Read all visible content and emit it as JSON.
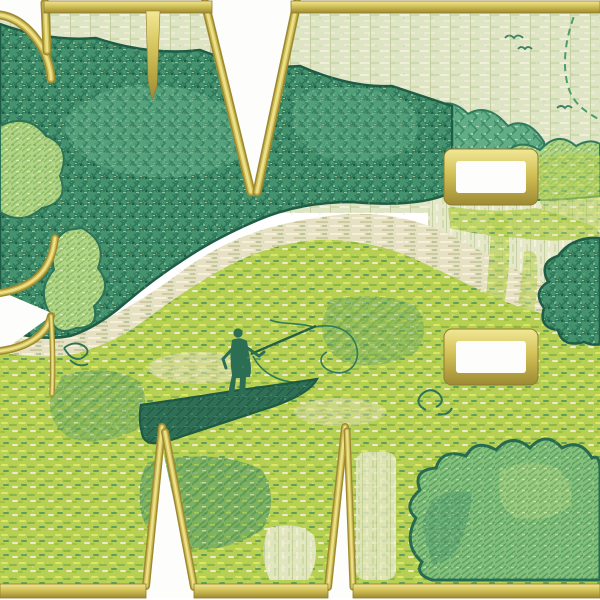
{
  "meta": {
    "description": "Machine-embroidery stitched preview: green landscape scene (fisherman standing in a boat on a river, forest, meadow, bushes, birds) filling large letterforms outlined in gold satin stitch on a white ground",
    "canvas": {
      "width": 600,
      "height": 600
    }
  },
  "palette": {
    "white_ground": "#fdfdfb",
    "gold_layers": [
      "#9d8a33",
      "#cdbb55",
      "#ede187"
    ],
    "gold_gradient": [
      "#f2e795",
      "#d2c157",
      "#9d8a33"
    ],
    "outline_dark_green": "#1f5c46",
    "forest_green": "#44926e",
    "forest_light": "#61ad85",
    "bush_light": "#b2d488",
    "bush_mid": "#83c07c",
    "meadow_chartreuse": "#b7cf52",
    "meadow_dark": "#74ad62",
    "sky_sage": "#dde5c4",
    "river_cream": "#e6e1c2",
    "field_pale": "#e6e8ca",
    "boat_teal": "#2e6f55",
    "figure_teal": "#2c6e54",
    "bird_green": "#38805f",
    "arc_green": "#4a9e6a"
  },
  "scene": {
    "elements": [
      {
        "name": "sky",
        "tag": "rect",
        "attrs": {
          "x": 0,
          "y": 8,
          "width": 600,
          "height": 205,
          "fill": "url(#pSky)"
        }
      },
      {
        "name": "pale-field-right",
        "tag": "path",
        "attrs": {
          "d": "M428,186 L600,186 L600,352 L428,352 Z",
          "fill": "url(#pField)"
        }
      },
      {
        "name": "distant-hills",
        "tag": "path",
        "attrs": {
          "d": "M345,188 L345,150 Q362,104 392,118 Q404,96 428,112 Q448,94 468,114 Q488,102 508,126 Q528,116 544,142 L548,188 Q446,200 345,188 Z",
          "fill": "url(#pForestLight)",
          "stroke": "#2f7a5c",
          "stroke-width": 2
        }
      },
      {
        "name": "bush-row-right",
        "tag": "path",
        "attrs": {
          "d": "M468,190 Q478,150 502,158 Q516,136 540,150 Q558,130 576,146 Q590,138 600,144 L600,196 Q534,204 468,196 Z",
          "fill": "url(#pBushLight)",
          "stroke": "#2f7a5c",
          "stroke-width": 2
        }
      },
      {
        "name": "meadow",
        "tag": "path",
        "attrs": {
          "d": "M0,330 Q40,346 80,346 Q130,338 172,296 Q214,254 262,236 Q305,222 345,220 Q395,218 440,240 Q480,262 520,284 Q560,300 600,304 L600,590 L0,590 Z",
          "fill": "url(#pMeadow)"
        }
      },
      {
        "name": "meadow-dark-patch-1",
        "tag": "path",
        "attrs": {
          "d": "M148,462 Q220,448 262,470 Q280,500 262,530 Q220,556 178,548 Q142,538 140,504 Q138,476 148,462 Z",
          "fill": "url(#pMeadowDark)",
          "opacity": 0.85
        }
      },
      {
        "name": "meadow-dark-patch-2",
        "tag": "path",
        "attrs": {
          "d": "M62,376 Q110,362 140,382 Q152,408 136,430 Q100,448 70,438 Q48,424 50,400 Z",
          "fill": "url(#pMeadowDark)",
          "opacity": 0.6
        }
      },
      {
        "name": "meadow-dark-patch-3",
        "tag": "path",
        "attrs": {
          "d": "M330,300 Q380,290 416,306 Q432,330 416,352 Q380,372 344,362 Q320,348 322,322 Z",
          "fill": "url(#pMeadowDark)",
          "opacity": 0.5
        }
      },
      {
        "name": "pale-patch-1",
        "tag": "path",
        "attrs": {
          "d": "M268,528 Q300,520 314,536 Q320,560 308,580 L270,580 Q258,556 268,528 Z",
          "fill": "url(#pField)",
          "opacity": 0.9
        }
      },
      {
        "name": "pale-patch-2",
        "tag": "rect",
        "attrs": {
          "x": 356,
          "y": 452,
          "width": 40,
          "height": 128,
          "rx": 10,
          "fill": "url(#pField)",
          "opacity": 0.8
        }
      },
      {
        "name": "water-glint-1",
        "tag": "ellipse",
        "attrs": {
          "cx": 200,
          "cy": 368,
          "rx": 52,
          "ry": 16,
          "fill": "url(#pRiver)",
          "opacity": 0.55
        }
      },
      {
        "name": "water-glint-2",
        "tag": "ellipse",
        "attrs": {
          "cx": 340,
          "cy": 412,
          "rx": 46,
          "ry": 14,
          "fill": "url(#pRiver)",
          "opacity": 0.45
        }
      },
      {
        "name": "river",
        "tag": "path",
        "attrs": {
          "d": "M0,334 Q60,342 108,318 Q150,296 186,268 Q226,240 268,228 Q312,216 352,214 Q400,212 444,232 Q484,252 524,274 Q562,292 600,296 L600,322 Q540,318 492,296 Q448,274 408,256 Q362,238 316,240 Q268,244 224,268 Q182,292 148,318 Q108,348 64,356 Q28,358 0,352 Z",
          "fill": "url(#pRiver)"
        }
      },
      {
        "name": "forest",
        "tag": "path",
        "attrs": {
          "d": "M0,24 Q50,42 96,38 Q150,56 200,50 Q250,70 300,66 Q350,88 392,86 Q428,98 452,106 L452,148 Q466,168 452,192 Q420,208 352,202 Q300,202 258,220 Q216,238 186,258 Q152,280 124,304 Q96,328 70,336 Q36,342 0,328 Z",
          "fill": "url(#pForest)",
          "stroke": "#1f5c46",
          "stroke-width": 2.5,
          "stroke-linejoin": "round"
        }
      },
      {
        "name": "forest-light-cloud-1",
        "tag": "path",
        "attrs": {
          "d": "M66,118 Q116,68 196,92 Q258,112 240,158 Q182,190 112,170 Q58,150 66,118 Z",
          "fill": "url(#pForestLight)",
          "opacity": 0.6
        }
      },
      {
        "name": "forest-light-cloud-2",
        "tag": "path",
        "attrs": {
          "d": "M296,96 Q348,76 404,100 Q428,120 410,150 Q360,170 316,154 Q284,134 296,96 Z",
          "fill": "url(#pForestLight)",
          "opacity": 0.5
        }
      },
      {
        "name": "canopy-left",
        "tag": "path",
        "attrs": {
          "d": "M0,126 Q28,112 46,136 Q72,146 60,176 Q70,202 42,208 Q22,226 0,212 Z",
          "fill": "url(#pBushLight)",
          "stroke": "#2c7256",
          "stroke-width": 2
        }
      },
      {
        "name": "leaf-clump-left",
        "tag": "path",
        "attrs": {
          "d": "M82,228 Q108,242 98,268 Q114,288 94,306 Q100,328 76,328 Q54,338 50,314 Q36,290 54,270 Q48,240 68,230 Z",
          "fill": "url(#pBushLight)",
          "stroke": "#2c7256",
          "stroke-width": 2
        }
      },
      {
        "name": "leaf-sprig",
        "tag": "path",
        "attrs": {
          "d": "M64,348 q10,-8 20,-2 q8,6 -2,12 q-10,4 -18,-10 M70,360 q8,8 18,4",
          "stroke": "#2c7256",
          "stroke-width": 1.8,
          "fill": "none"
        }
      },
      {
        "name": "meadow-under-rect1",
        "tag": "path",
        "attrs": {
          "d": "M448,206 Q492,214 536,208 Q560,214 588,224 Q600,228 600,236 Q560,244 520,238 Q480,236 450,228 Z",
          "fill": "url(#pMeadow)",
          "opacity": 0.8
        }
      },
      {
        "name": "meadow-right-of-rect1",
        "tag": "path",
        "attrs": {
          "d": "M540,158 Q572,150 600,156 L600,230 Q570,226 544,214 Q534,186 540,158 Z",
          "fill": "url(#pMeadow)",
          "opacity": 0.55
        }
      },
      {
        "name": "field-grass-tuft-1",
        "tag": "path",
        "attrs": {
          "d": "M492,214 q14,-6 16,10 q4,40 -4,80 q-2,24 -12,22 q-8,-4 -6,-30 q4,-44 6,-82 Z",
          "fill": "url(#pMeadow)",
          "opacity": 0.7
        }
      },
      {
        "name": "field-grass-tuft-2",
        "tag": "path",
        "attrs": {
          "d": "M524,252 q12,-4 13,8 q2,30 -4,60 q-3,16 -11,13 q-7,-4 -4,-26 q4,-30 6,-55 Z",
          "fill": "url(#pMeadow)",
          "opacity": 0.6
        }
      },
      {
        "name": "dark-bush-right-edge",
        "tag": "path",
        "attrs": {
          "d": "M600,238 Q572,236 558,256 Q538,262 548,282 Q532,292 544,308 Q538,328 558,330 Q562,348 584,342 Q594,346 600,344 Z",
          "fill": "url(#pForest)",
          "stroke": "#1f5c46",
          "stroke-width": 2.5
        }
      },
      {
        "name": "bush-bottom-right",
        "tag": "path",
        "attrs": {
          "d": "M422,562 Q402,544 416,518 Q402,506 420,490 Q412,470 436,468 Q442,448 466,456 Q476,438 496,450 Q512,432 530,448 Q546,430 562,448 Q580,438 592,458 Q600,454 600,470 L600,580 L432,580 Q414,574 422,562 Z",
          "fill": "url(#pBushMid)",
          "stroke": "#276a50",
          "stroke-width": 3
        }
      },
      {
        "name": "bush-bottom-right-shade",
        "tag": "path",
        "attrs": {
          "d": "M428,548 Q416,522 432,502 Q446,488 472,492 Q470,520 458,548 Q446,566 432,564 Z",
          "fill": "url(#pForest)",
          "opacity": 0.35
        }
      },
      {
        "name": "bush-bottom-right-highlight",
        "tag": "path",
        "attrs": {
          "d": "M500,470 Q530,456 556,468 Q576,482 570,506 Q548,524 516,518 Q494,506 500,470 Z",
          "fill": "url(#pBushLight)",
          "opacity": 0.5
        }
      },
      {
        "name": "curl-motif",
        "tag": "path",
        "attrs": {
          "d": "M426,410 q-12,-6 -5,-15 q9,-9 18,-1 q7,8 -3,13 M438,414 q10,2 14,-6",
          "stroke": "#2c7256",
          "stroke-width": 2,
          "fill": "none"
        }
      },
      {
        "name": "fishing-line",
        "tag": "path",
        "attrs": {
          "d": "M314,327 C340,322 354,334 357,349 C360,365 347,376 333,372 C320,368 317,357 327,352 M314,327 C298,322 283,325 270,320 M253,356 C262,374 282,384 302,382",
          "stroke": "#2f7a5c",
          "stroke-width": 1.6,
          "fill": "none"
        }
      },
      {
        "name": "fishing-rod",
        "tag": "path",
        "attrs": {
          "d": "M251,354 L316,326",
          "stroke": "#235e48",
          "stroke-width": 2.4
        }
      },
      {
        "name": "boat",
        "tag": "path",
        "attrs": {
          "d": "M141,405 Q190,398 240,390 Q285,384 317,379 Q308,396 262,410 Q214,426 168,441 Q148,447 143,437 Q138,421 141,405 Z",
          "fill": "url(#pBoat)",
          "stroke": "#1d5a42",
          "stroke-width": 2.2
        }
      },
      {
        "name": "fisherman-body",
        "tag": "path",
        "attrs": {
          "d": "M232,340 Q240,336 247,341 L250,360 Q252,369 250,377 L246,377 L245,395 L239,395 L240,378 L236,378 L234,395 L228,394 L232,375 Q229,357 232,340 Z",
          "fill": "#2c6e54"
        }
      },
      {
        "name": "fisherman-head",
        "tag": "circle",
        "attrs": {
          "cx": 238,
          "cy": 333,
          "r": 4.6,
          "fill": "#2c6e54"
        }
      },
      {
        "name": "fisherman-arms",
        "tag": "path",
        "attrs": {
          "d": "M246,347 L259,356 L264,352 M234,347 L223,359 L226,368",
          "stroke": "#2c6e54",
          "stroke-width": 3,
          "fill": "none",
          "stroke-linecap": "round"
        }
      },
      {
        "name": "birds",
        "tag": "path",
        "attrs": {
          "d": "M505,38 q4,-5 9,0 q4,-5 9,0 M518,49 q3,-4 7,0 q3,-4 7,0 M557,108 q4,-4 8,0 q3,-4 7,0",
          "stroke": "#38805f",
          "stroke-width": 1.8,
          "fill": "none"
        }
      },
      {
        "name": "stitched-arc",
        "tag": "path",
        "attrs": {
          "d": "M578,6 C566,34 560,66 570,92 C577,107 588,113 600,120",
          "stroke": "#4a9e6a",
          "stroke-width": 2,
          "stroke-dasharray": "7 5",
          "fill": "none"
        }
      },
      {
        "name": "fabric-noise",
        "tag": "rect",
        "attrs": {
          "x": 0,
          "y": 0,
          "width": 600,
          "height": 600,
          "fill": "url(#pNoise)",
          "opacity": 0.6
        }
      },
      {
        "name": "white-corner-wedge",
        "tag": "path",
        "attrs": {
          "d": "M0,0 L45,0 L47,53 C32,27 14,17 0,14 Z",
          "fill": "#fdfdfb"
        }
      },
      {
        "name": "gold-corner-curve",
        "tag": "goldpath",
        "w": 9,
        "attrs": {
          "d": "M0,15 C15,17 32,28 45,53 C49,64 51,73 51,79"
        }
      },
      {
        "name": "gold-corner-vertical",
        "tag": "goldpath",
        "w": 9,
        "attrs": {
          "d": "M45,3 L47,51"
        }
      },
      {
        "name": "white-top-v-notch",
        "tag": "path",
        "attrs": {
          "d": "M207,0 L298,0 L254,197 Z",
          "fill": "#fdfdfb"
        }
      },
      {
        "name": "gold-top-v-left",
        "tag": "goldpath",
        "w": 9,
        "attrs": {
          "d": "M205,3 L251,192"
        }
      },
      {
        "name": "gold-top-v-right",
        "tag": "goldpath",
        "w": 9,
        "attrs": {
          "d": "M297,3 L257,192"
        }
      },
      {
        "name": "white-left-notch",
        "tag": "path",
        "attrs": {
          "d": "M0,291 L54,314 L0,353 Z",
          "fill": "#fdfdfb"
        }
      },
      {
        "name": "gold-left-notch-upper",
        "tag": "goldpath",
        "w": 8,
        "attrs": {
          "d": "M55,238 C52,266 38,287 0,293"
        }
      },
      {
        "name": "gold-left-notch-lower",
        "tag": "goldpath",
        "w": 8,
        "attrs": {
          "d": "M0,351 C30,347 47,333 51,316"
        }
      },
      {
        "name": "gold-left-notch-tail",
        "tag": "goldpath",
        "w": 5.5,
        "attrs": {
          "d": "M51,316 C53,346 53,372 52,394"
        }
      },
      {
        "name": "white-bottom-notch-1",
        "tag": "path",
        "attrs": {
          "d": "M161,442 L144,598 L195,598 Z",
          "fill": "#fdfdfb"
        }
      },
      {
        "name": "gold-bottom-notch-1-left",
        "tag": "goldpath",
        "w": 8,
        "attrs": {
          "d": "M162,427 L146,586"
        }
      },
      {
        "name": "gold-bottom-notch-1-right",
        "tag": "goldpath",
        "w": 8,
        "attrs": {
          "d": "M165,432 L194,587"
        }
      },
      {
        "name": "white-bottom-notch-2",
        "tag": "path",
        "attrs": {
          "d": "M344,442 L326,598 L354,598 Z",
          "fill": "#fdfdfb"
        }
      },
      {
        "name": "gold-bottom-notch-2-left",
        "tag": "goldpath",
        "w": 8,
        "attrs": {
          "d": "M345,427 L328,587"
        }
      },
      {
        "name": "gold-bottom-notch-2-right",
        "tag": "goldpath",
        "w": 7,
        "attrs": {
          "d": "M347,431 L353,587"
        }
      },
      {
        "name": "gold-band-top-left",
        "tag": "rect",
        "attrs": {
          "x": 44,
          "y": 1,
          "width": 168,
          "height": 12,
          "fill": "url(#gGoldV)",
          "stroke": "#8f7c2c",
          "stroke-width": 0.8
        }
      },
      {
        "name": "gold-band-top-right",
        "tag": "rect",
        "attrs": {
          "x": 291,
          "y": 1,
          "width": 309,
          "height": 12,
          "fill": "url(#gGoldV)",
          "stroke": "#8f7c2c",
          "stroke-width": 0.8
        }
      },
      {
        "name": "gold-band-bottom-left",
        "tag": "rect",
        "attrs": {
          "x": 0,
          "y": 584,
          "width": 146,
          "height": 14,
          "fill": "url(#gGoldV)",
          "stroke": "#8f7c2c",
          "stroke-width": 0.8
        }
      },
      {
        "name": "gold-band-bottom-mid",
        "tag": "rect",
        "attrs": {
          "x": 194,
          "y": 584,
          "width": 134,
          "height": 14,
          "fill": "url(#gGoldV)",
          "stroke": "#8f7c2c",
          "stroke-width": 0.8
        }
      },
      {
        "name": "gold-band-bottom-right",
        "tag": "rect",
        "attrs": {
          "x": 353,
          "y": 584,
          "width": 247,
          "height": 14,
          "fill": "url(#gGoldV)",
          "stroke": "#8f7c2c",
          "stroke-width": 0.8
        }
      },
      {
        "name": "gold-taper-bar-top",
        "tag": "path",
        "attrs": {
          "d": "M146,11 L160,11 L157,86 L152,100 L148,80 Z",
          "fill": "url(#gGoldV)",
          "stroke": "#8f7c2c",
          "stroke-width": 0.6
        }
      },
      {
        "name": "gold-rectangle-1-border",
        "tag": "rect",
        "attrs": {
          "x": 444,
          "y": 149,
          "width": 94,
          "height": 56,
          "rx": 8,
          "fill": "url(#gGoldV)",
          "stroke": "#8f7c2c",
          "stroke-width": 1
        }
      },
      {
        "name": "rectangle-1-white",
        "tag": "rect",
        "attrs": {
          "x": 456,
          "y": 161,
          "width": 70,
          "height": 32,
          "rx": 3,
          "fill": "#fdfdfb"
        }
      },
      {
        "name": "gold-rectangle-2-border",
        "tag": "rect",
        "attrs": {
          "x": 444,
          "y": 329,
          "width": 94,
          "height": 56,
          "rx": 8,
          "fill": "url(#gGoldV)",
          "stroke": "#8f7c2c",
          "stroke-width": 1
        }
      },
      {
        "name": "rectangle-2-white",
        "tag": "rect",
        "attrs": {
          "x": 456,
          "y": 341,
          "width": 70,
          "height": 32,
          "rx": 3,
          "fill": "#fdfdfb"
        }
      }
    ]
  }
}
